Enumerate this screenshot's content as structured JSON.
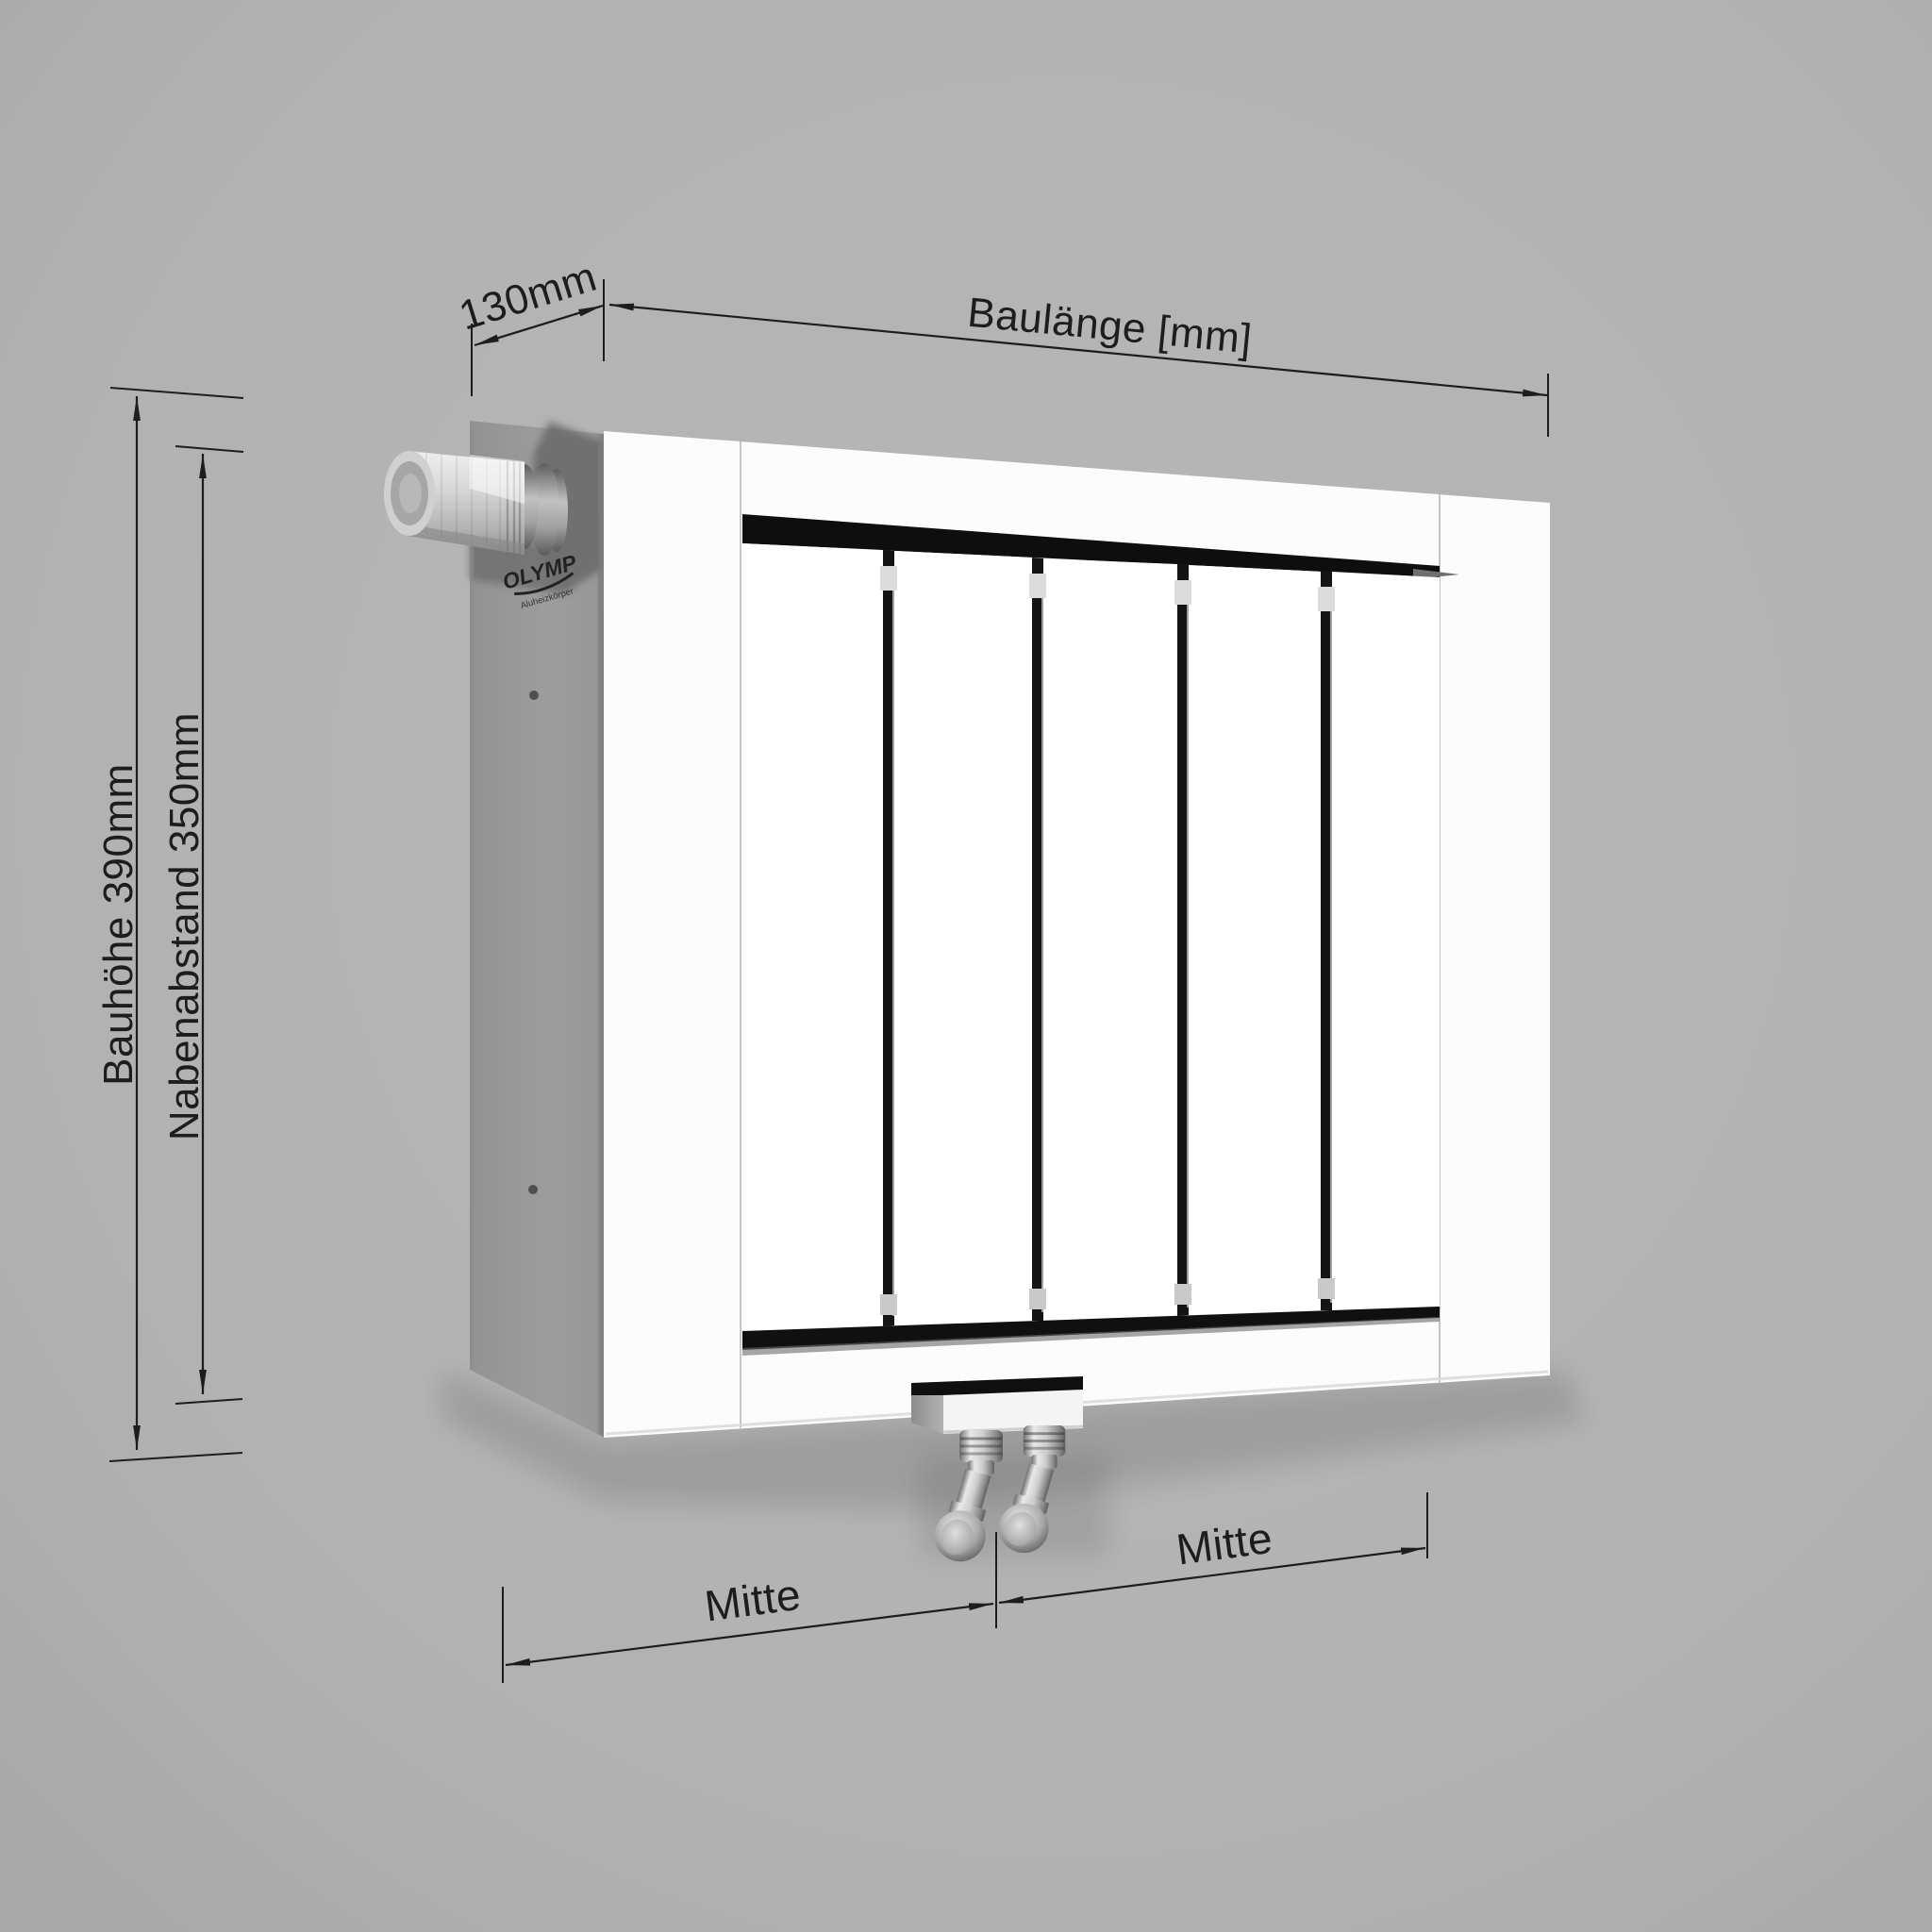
{
  "labels": {
    "depth": "130mm",
    "length": "Baulänge [mm]",
    "height": "Bauhöhe 390mm",
    "hub_spacing": "Nabenabstand 350mm",
    "center_left": "Mitte",
    "center_right": "Mitte"
  },
  "brand": {
    "name": "OLYMP",
    "tagline": "Aluheizkörper"
  },
  "product": {
    "type": "flat-panel radiator, perspective technical rendering",
    "panel_count": "5"
  },
  "colors": {
    "background": "#b3b3b3",
    "side_panel": "#9a9a9a",
    "front_face": "#fcfcfc",
    "slot_dark": "#101010",
    "dimension_ink": "#1d1d1d",
    "chrome_light": "#e9e9e9",
    "chrome_dark": "#6f6f6f"
  }
}
